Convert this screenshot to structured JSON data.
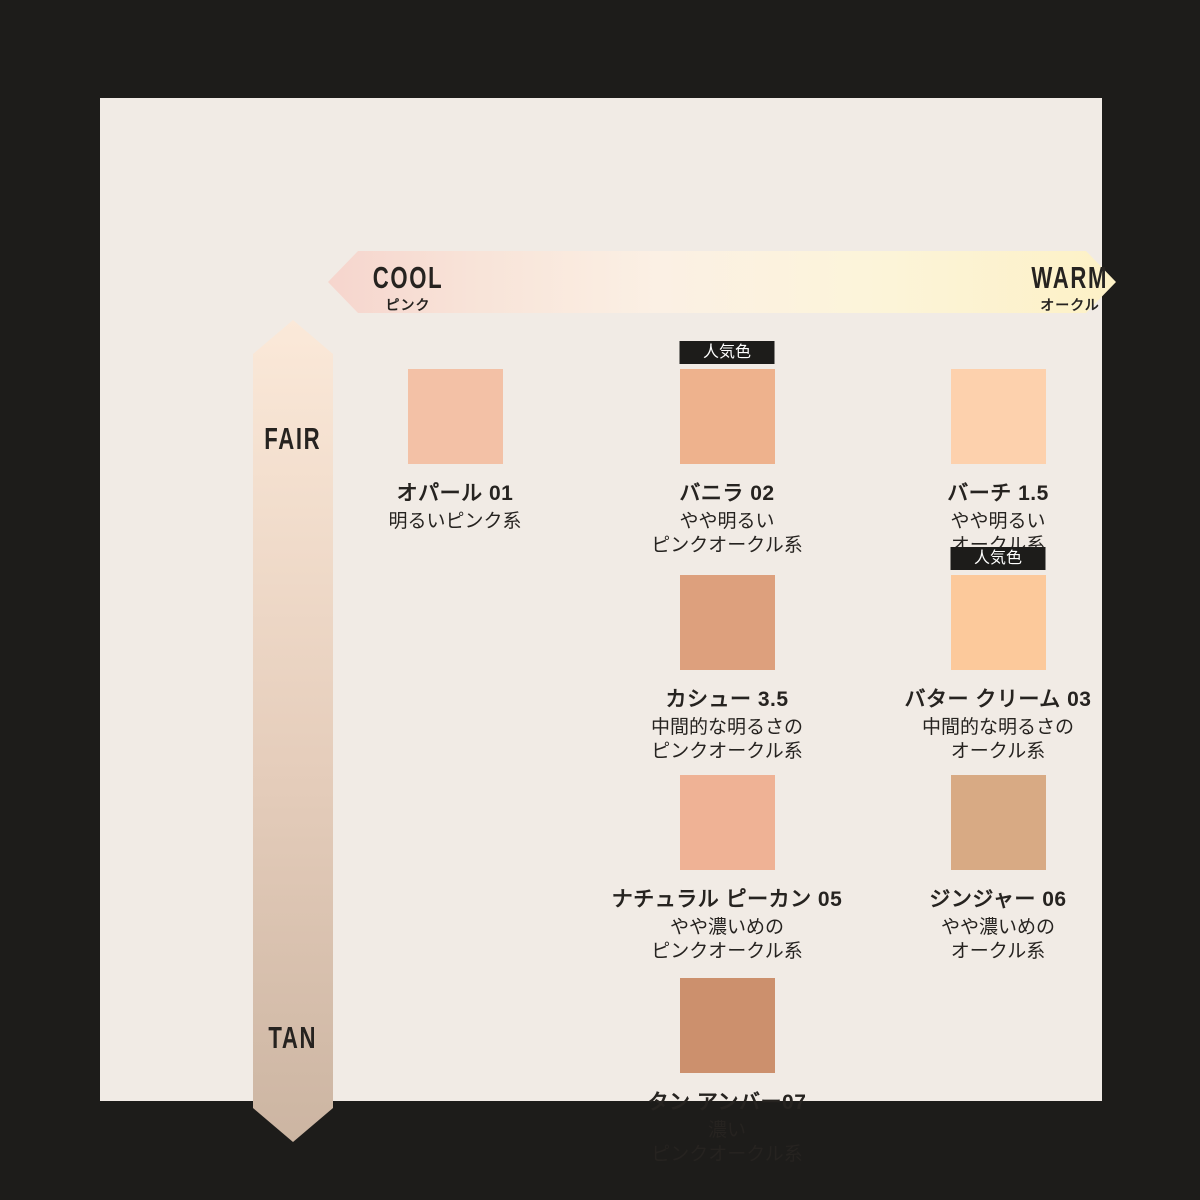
{
  "frame": {
    "outer_bg": "#1d1c1a",
    "panel_bg": "#f1ebe5",
    "text_color": "#262320"
  },
  "top_axis": {
    "left_label": "COOL",
    "left_sub": "ピンク",
    "right_label": "WARM",
    "right_sub": "オークル",
    "gradient_css": "linear-gradient(90deg, #f6d5cd 0%, #f8e3d8 18%, #fbf0e4 42%, #fcf4da 68%, #fdf1c6 100%)"
  },
  "side_axis": {
    "top_label": "FAIR",
    "bottom_label": "TAN",
    "gradient_css": "linear-gradient(180deg, #fbe9d9 0%, #e5cdbb 55%, #ccb5a2 100%)"
  },
  "badge_label": "人気色",
  "shades": [
    {
      "name": "オパール 01",
      "desc": "明るいピンク系",
      "color": "#f3c1a6",
      "popular": false
    },
    {
      "name": "バニラ 02",
      "desc": "やや明るい\nピンクオークル系",
      "color": "#eeb28d",
      "popular": true
    },
    {
      "name": "バーチ 1.5",
      "desc": "やや明るい\nオークル系",
      "color": "#fdd1ad",
      "popular": false
    },
    {
      "name": "カシュー 3.5",
      "desc": "中間的な明るさの\nピンクオークル系",
      "color": "#dda07d",
      "popular": false
    },
    {
      "name": "バター クリーム 03",
      "desc": "中間的な明るさの\nオークル系",
      "color": "#fcc99b",
      "popular": true
    },
    {
      "name": "ナチュラル ピーカン 05",
      "desc": "やや濃いめの\nピンクオークル系",
      "color": "#efb295",
      "popular": false
    },
    {
      "name": "ジンジャー 06",
      "desc": "やや濃いめの\nオークル系",
      "color": "#d8aa84",
      "popular": false
    },
    {
      "name": "タン アンバー07",
      "desc": "濃い\nピンクオークル系",
      "color": "#cc906d",
      "popular": false
    }
  ]
}
